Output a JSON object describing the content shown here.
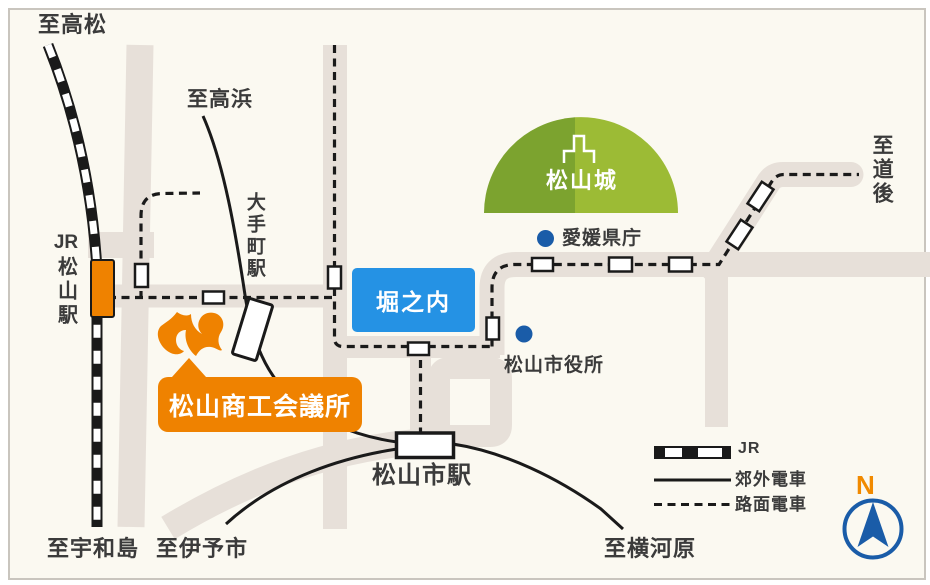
{
  "map": {
    "destinations": {
      "takamatsu": "至高松",
      "takahama": "至高浜",
      "dogo": "至道後",
      "uwajima": "至宇和島",
      "iyoshi": "至伊予市",
      "yokogawara": "至横河原"
    },
    "stations": {
      "jr_prefix": "JR",
      "jr_matsuyama": "松山駅",
      "otemachi": "大手町駅",
      "matsuyamashi": "松山市駅"
    },
    "places": {
      "castle": "松山城",
      "prefectural_office": "愛媛県庁",
      "city_hall": "松山市役所",
      "horinouchi": "堀之内",
      "chamber_of_commerce": "松山商工会議所"
    },
    "legend": {
      "jr": "JR",
      "suburban": "郊外電車",
      "tram": "路面電車"
    },
    "compass_n": "N"
  },
  "colors": {
    "background": "#FBF9F1",
    "road": "#E7E0D9",
    "orange": "#EF8200",
    "blue_box": "#2592E4",
    "marker_blue": "#1A5CA8",
    "castle_green_dark": "#7CA32F",
    "castle_green_light": "#9CBB35",
    "line_black": "#1A1A1A",
    "text": "#3B3B3B"
  }
}
